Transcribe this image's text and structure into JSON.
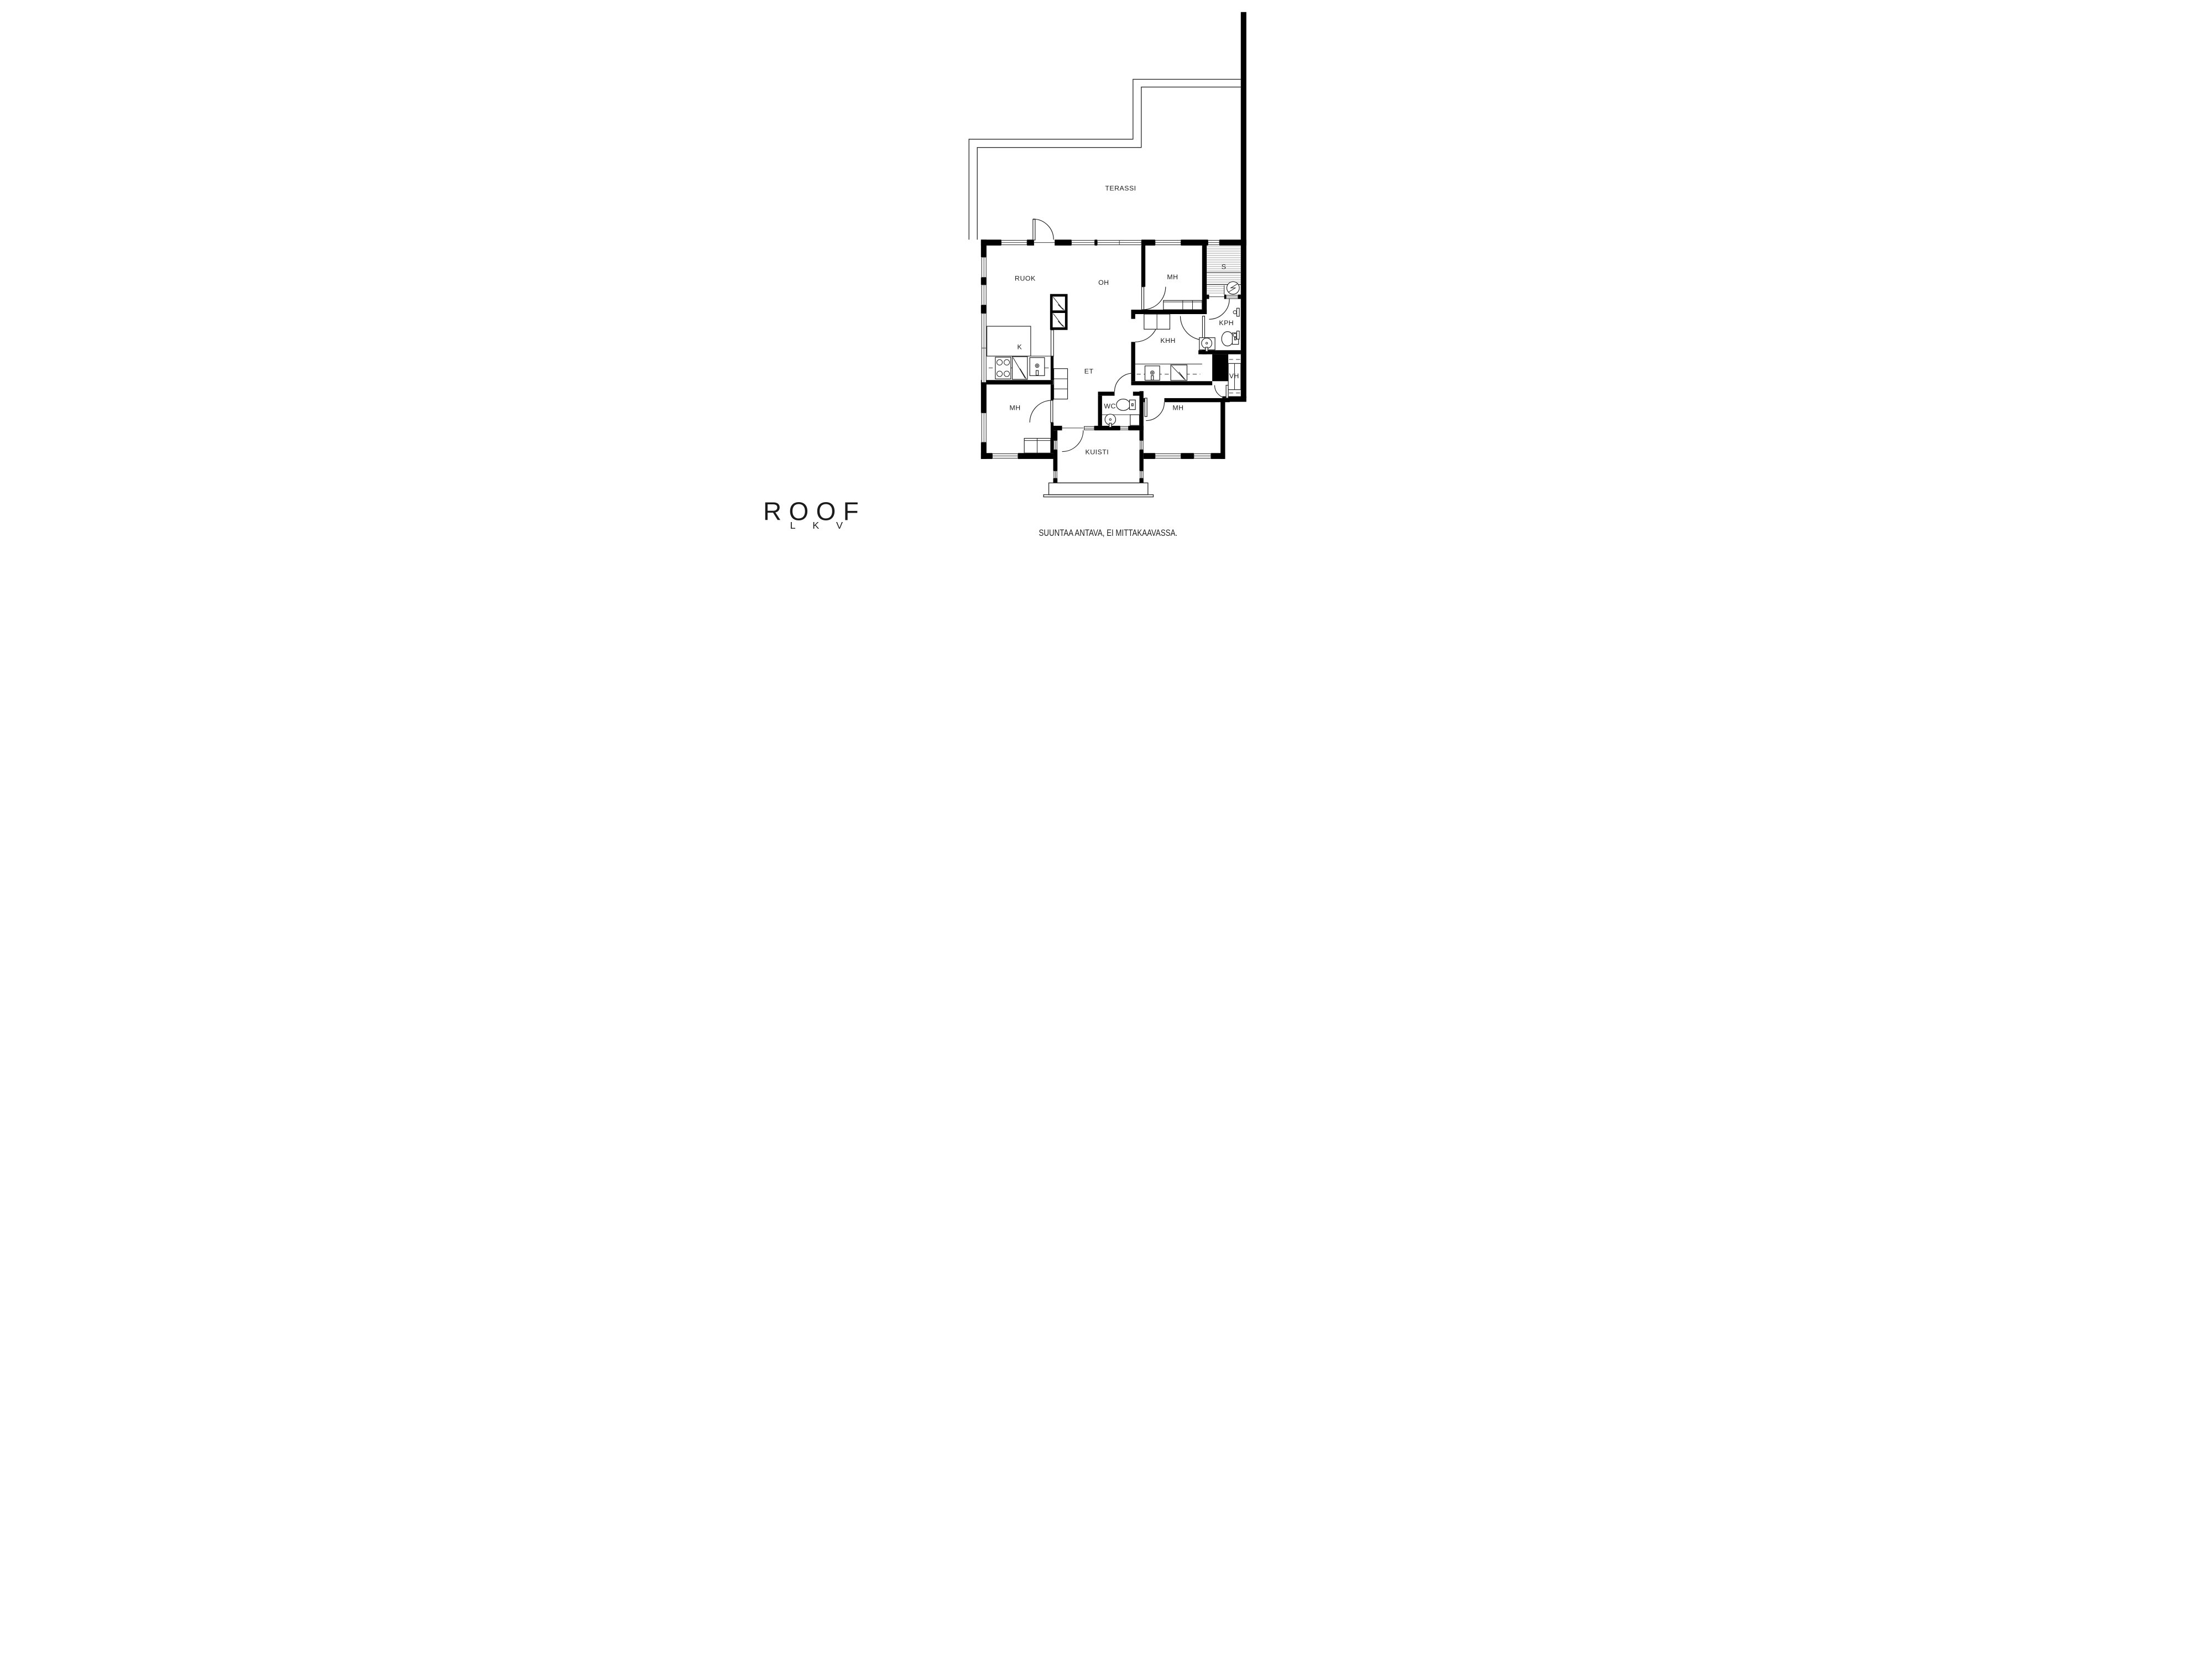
{
  "plan": {
    "colors": {
      "wall": "#000000",
      "line": "#1f1f1f",
      "hatch": "#8f8f8f",
      "background": "#ffffff",
      "text": "#1c1c1c"
    },
    "rooms": [
      {
        "id": "terassi",
        "label": "TERASSI"
      },
      {
        "id": "ruok",
        "label": "RUOK"
      },
      {
        "id": "oh",
        "label": "OH"
      },
      {
        "id": "mh_top",
        "label": "MH"
      },
      {
        "id": "sauna",
        "label": "S"
      },
      {
        "id": "kph",
        "label": "KPH"
      },
      {
        "id": "khh",
        "label": "KHH"
      },
      {
        "id": "k",
        "label": "K"
      },
      {
        "id": "et",
        "label": "ET"
      },
      {
        "id": "vh",
        "label": "VH"
      },
      {
        "id": "mh_left",
        "label": "MH"
      },
      {
        "id": "wc",
        "label": "WC"
      },
      {
        "id": "mh_right",
        "label": "MH"
      },
      {
        "id": "kuisti",
        "label": "KUISTI"
      }
    ],
    "logo": {
      "name": "ROOF",
      "sub": "LKV"
    },
    "footer_note": "SUUNTAA ANTAVA, EI MITTAKAAVASSA."
  }
}
